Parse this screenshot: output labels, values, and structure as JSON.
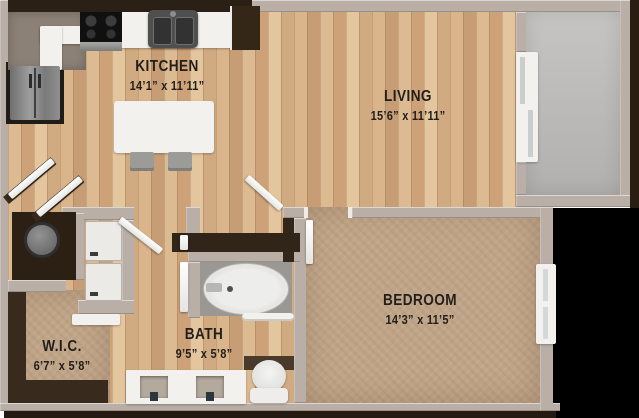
{
  "rooms": {
    "kitchen": {
      "name": "KITCHEN",
      "dims": "14’1” x 11’11”"
    },
    "living": {
      "name": "LIVING",
      "dims": "15’6” x 11’11”"
    },
    "bedroom": {
      "name": "BEDROOM",
      "dims": "14’3” x 11’5”"
    },
    "bath": {
      "name": "BATH",
      "dims": "9’5” x 5’8”"
    },
    "wic": {
      "name": "W.I.C.",
      "dims": "6’7” x 5’8”"
    }
  },
  "fixtures": {
    "refrigerator": "css-stainless-rect",
    "range-cooktop": "css-black-rect-burners",
    "kitchen-sink": "css-double-basin",
    "kitchen-counter": "css-white-band",
    "pantry-cabinet": "css-dark-rect",
    "dining-table": "css-white-rounded-rect",
    "dining-chair": "css-gray-rect",
    "sliding-glass-door": "css-white-panels",
    "balcony": "css-gray-slab",
    "water-heater": "css-circle",
    "washer-dryer-stack": "css-stacked-white-squares",
    "bathtub": "css-white-oval",
    "towel-bar": "css-chrome-bar",
    "double-vanity": "css-white-rect-two-basins",
    "toilet": "css-oval-plus-tank",
    "closet-shelving": "css-dark-bands",
    "closet-rod-shelf": "css-white-bar",
    "bedroom-window": "css-white-frame",
    "door-leaf": "css-white-diagonal-bar"
  },
  "colors": {
    "background": "#ffffff",
    "wall": "#b9afa7",
    "wood_floor": "#d2ad83",
    "carpet": "#c0a588",
    "balcony_floor": "#bcbbb9",
    "cabinet_dark": "#33261a",
    "exterior_shadow": "#000000",
    "fixture_white": "#f2f1ee",
    "label_text": "#221f1b"
  }
}
